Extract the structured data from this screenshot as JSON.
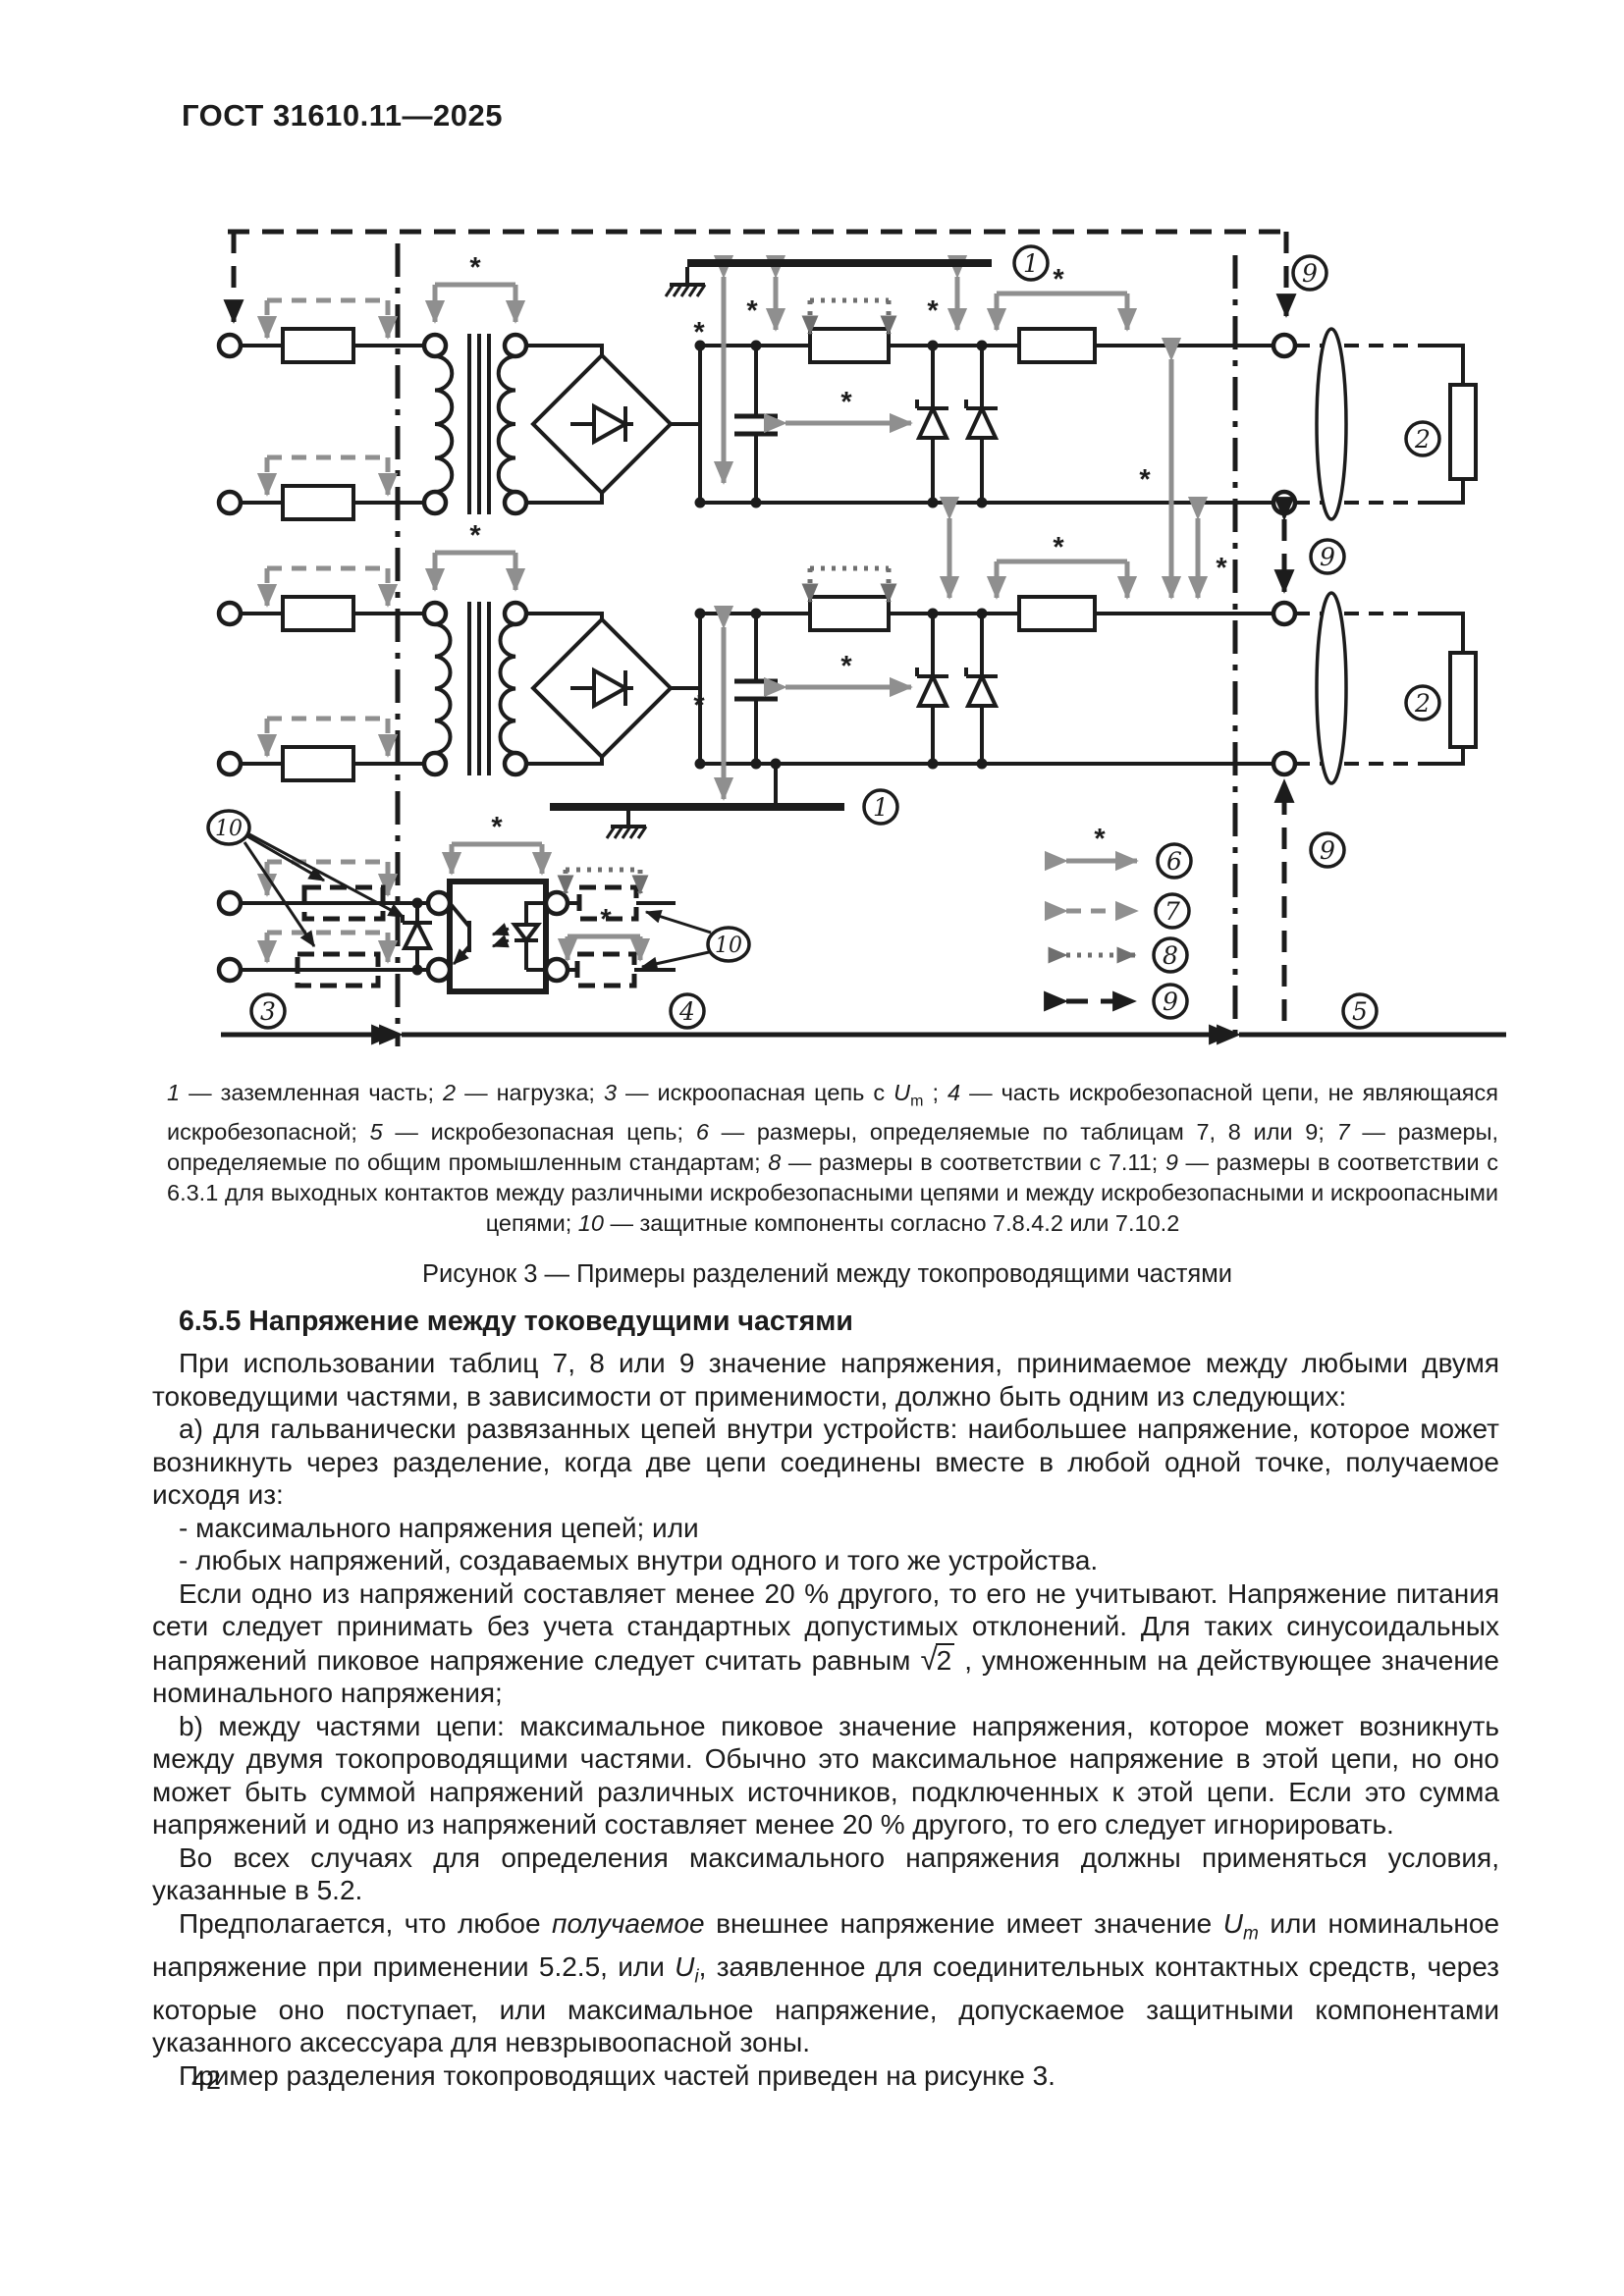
{
  "page": {
    "standard_code": "ГОСТ 31610.11—2025",
    "page_number": "42"
  },
  "figure": {
    "title": "Рисунок 3 — Примеры разделений между токопроводящими частями",
    "caption_segments": [
      {
        "t": "1",
        "s": "i"
      },
      {
        "t": " — заземленная часть; "
      },
      {
        "t": "2",
        "s": "i"
      },
      {
        "t": " — нагрузка; "
      },
      {
        "t": "3",
        "s": "i"
      },
      {
        "t": " — искроопасная цепь с "
      },
      {
        "t": "U",
        "s": "i"
      },
      {
        "t": "m",
        "s": "sub"
      },
      {
        "t": " ; "
      },
      {
        "t": "4",
        "s": "i"
      },
      {
        "t": " — часть искробезопасной цепи, не являющаяся искробезопасной; "
      },
      {
        "t": "5",
        "s": "i"
      },
      {
        "t": " — искробезопасная цепь; "
      },
      {
        "t": "6",
        "s": "i"
      },
      {
        "t": " — размеры, определяемые по таблицам 7, 8 или 9; "
      },
      {
        "t": "7",
        "s": "i"
      },
      {
        "t": " — размеры, определяемые по общим промышленным стандартам; "
      },
      {
        "t": "8",
        "s": "i"
      },
      {
        "t": " — размеры в соответствии с 7.11; "
      },
      {
        "t": "9",
        "s": "i"
      },
      {
        "t": " — размеры в соответствии с 6.3.1 для выходных контактов между различными искробезопасными цепями и между искробезопасными и искроопасными цепями; "
      },
      {
        "t": "10",
        "s": "i"
      },
      {
        "t": " — защитные компоненты согласно 7.8.4.2 или 7.10.2"
      }
    ],
    "diagram": {
      "asterisk": "*",
      "labels": {
        "n1": "1",
        "n2": "2",
        "n3": "3",
        "n4": "4",
        "n5": "5",
        "n6": "6",
        "n7": "7",
        "n8": "8",
        "n9": "9",
        "n10": "10"
      },
      "colors": {
        "black": "#1c1c1c",
        "dimension_gray": "#8f8f8f",
        "dotted_dark_gray": "#6f6f6f"
      }
    }
  },
  "section": {
    "heading": "6.5.5 Напряжение между токоведущими частями",
    "paragraphs": [
      [
        {
          "t": "При использовании таблиц 7, 8 или 9 значение напряжения, принимаемое между любыми двумя токоведущими частями, в зависимости от применимости, должно быть одним из следующих:"
        }
      ],
      [
        {
          "t": "а) для гальванически развязанных цепей внутри устройств: наибольшее напряжение, которое может возникнуть через разделение, когда две цепи соединены вместе в любой одной точке, получаемое исходя из:"
        }
      ],
      [
        {
          "t": "- максимального напряжения цепей; или"
        }
      ],
      [
        {
          "t": "- любых напряжений, создаваемых внутри одного и того же устройства."
        }
      ],
      [
        {
          "t": "Если одно из напряжений составляет менее 20 % другого, то его не учитывают. Напряжение питания сети следует принимать без учета стандартных допустимых отклонений. Для таких синусоидальных напряжений пиковое напряжение следует считать равным "
        },
        {
          "t": "√",
          "s": "rad"
        },
        {
          "t": "2",
          "s": "ovl"
        },
        {
          "t": " , умноженным на действующее значение номинального напряжения;"
        }
      ],
      [
        {
          "t": "b) между частями цепи: максимальное пиковое значение напряжения, которое может возникнуть между двумя токопроводящими частями. Обычно это максимальное напряжение в этой цепи, но оно может быть суммой напряжений различных источников, подключенных к этой цепи. Если это сумма напряжений и одно из напряжений составляет менее 20 % другого, то его следует игнорировать."
        }
      ],
      [
        {
          "t": "Во всех случаях для определения максимального напряжения должны применяться условия, указанные в 5.2."
        }
      ],
      [
        {
          "t": "Предполагается, что любое "
        },
        {
          "t": "получаемое",
          "s": "i"
        },
        {
          "t": " внешнее напряжение имеет значение "
        },
        {
          "t": "U",
          "s": "i"
        },
        {
          "t": "m",
          "s": "subi"
        },
        {
          "t": " или номинальное напряжение при применении 5.2.5, или "
        },
        {
          "t": "U",
          "s": "i"
        },
        {
          "t": "i",
          "s": "subi"
        },
        {
          "t": ", заявленное для соединительных контактных средств, через которые оно поступает, или максимальное напряжение, допускаемое защитными компонентами указанного аксессуара для невзрывоопасной зоны."
        }
      ],
      [
        {
          "t": "Пример разделения токопроводящих частей приведен на рисунке 3."
        }
      ]
    ]
  }
}
